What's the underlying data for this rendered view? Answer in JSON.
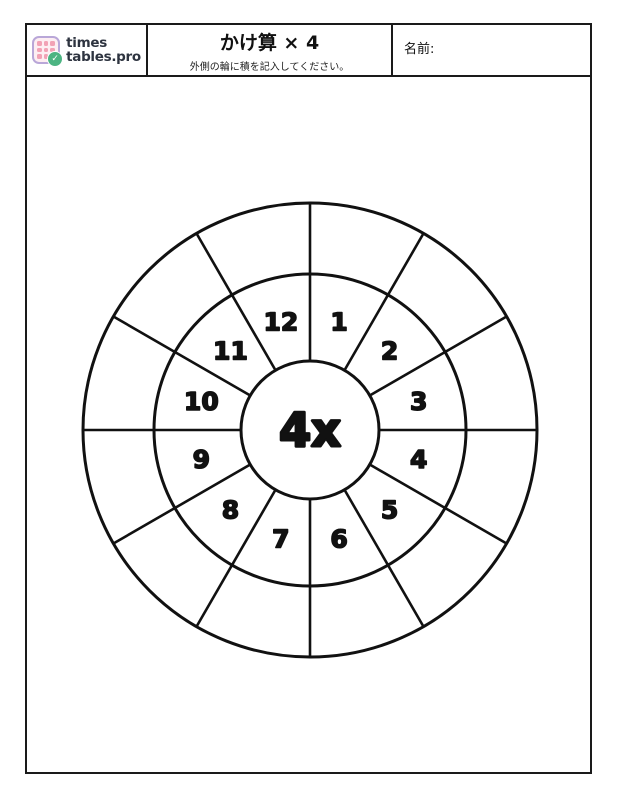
{
  "header": {
    "logo": {
      "line1": "times",
      "line2": "tables.pro",
      "icon": "grid-calendar-icon",
      "check_icon": "checkmark-icon"
    },
    "title": "かけ算 × 4",
    "subtitle": "外側の輪に積を記入してください。",
    "name_label": "名前:"
  },
  "wheel": {
    "center_label": "4x",
    "multiplier": 4,
    "numbers": [
      1,
      2,
      3,
      4,
      5,
      6,
      7,
      8,
      9,
      10,
      11,
      12
    ],
    "outer_answers": [
      "",
      "",
      "",
      "",
      "",
      "",
      "",
      "",
      "",
      "",
      "",
      ""
    ]
  },
  "colors": {
    "line": "#111111",
    "border": "#1a1a1a",
    "logo_text": "#2e3440",
    "logo_icon_border": "#b9a7d8",
    "logo_icon_bg": "#fdeef2",
    "logo_dot": "#f2a2b5",
    "logo_check_bg": "#4cb482",
    "logo_check": "#ffffff"
  }
}
